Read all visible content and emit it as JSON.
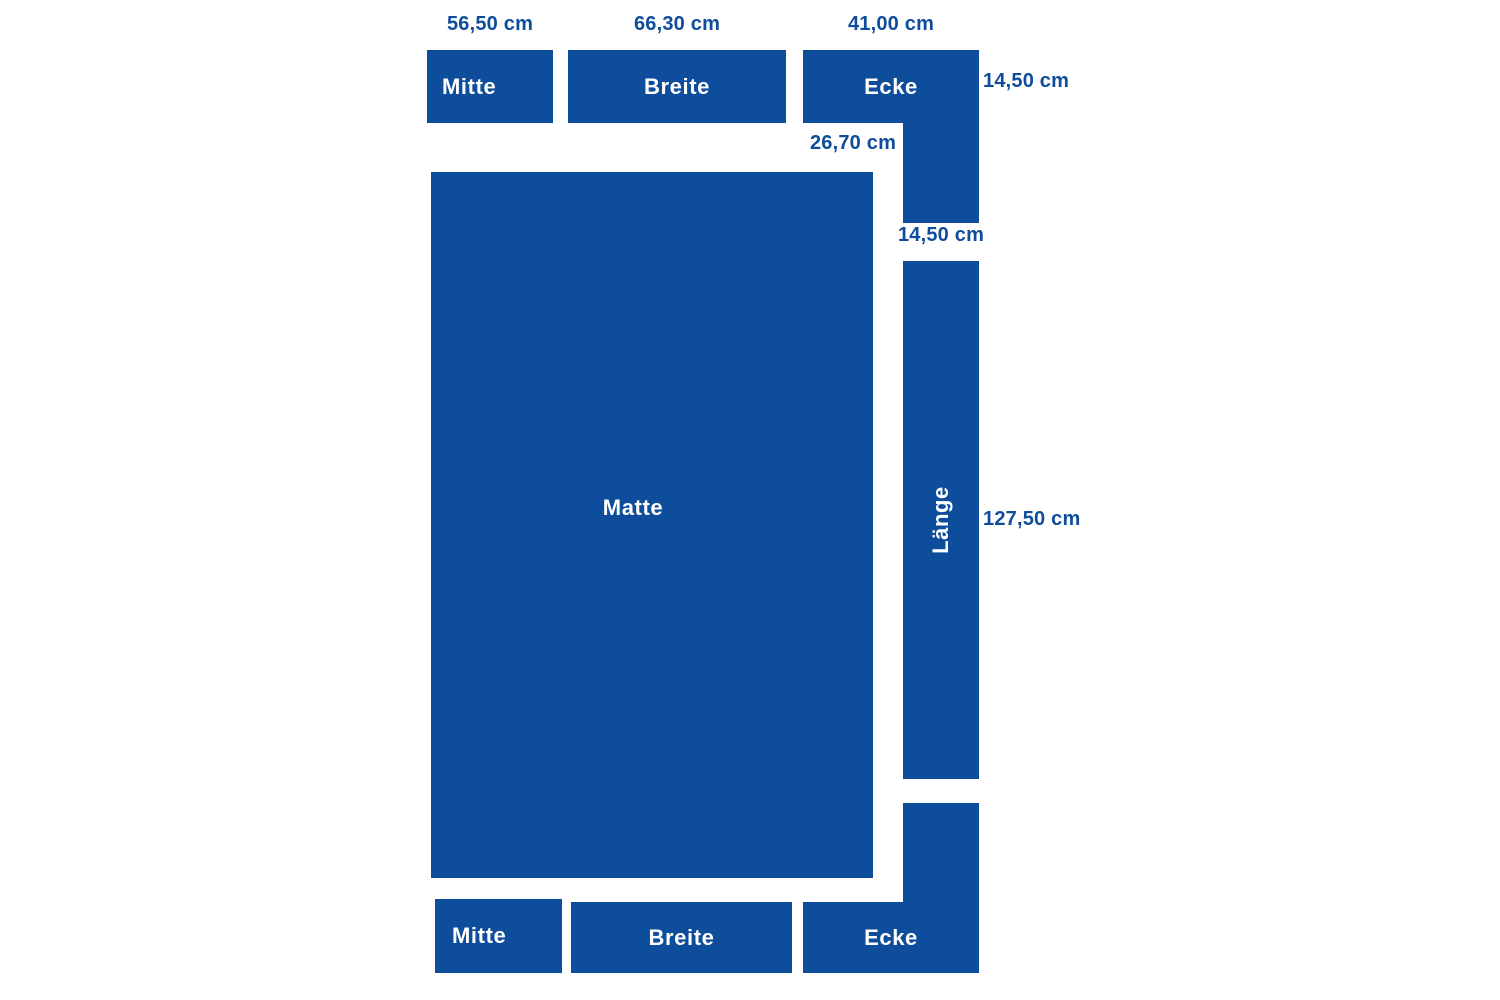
{
  "colors": {
    "primary": "#0e4d9b",
    "background": "#ffffff",
    "piece_label": "#ffffff"
  },
  "pieces": {
    "top_mitte": {
      "label": "Mitte",
      "width_dim": "56,50 cm"
    },
    "top_breite": {
      "label": "Breite",
      "width_dim": "66,30 cm"
    },
    "top_ecke": {
      "label": "Ecke",
      "width_dim": "41,00 cm",
      "side_dim": "14,50 cm",
      "notch_dim": "26,70 cm",
      "leg_dim": "14,50 cm"
    },
    "matte": {
      "label": "Matte"
    },
    "laenge": {
      "label": "Länge",
      "length_dim": "127,50 cm"
    },
    "bottom_mitte": {
      "label": "Mitte"
    },
    "bottom_breite": {
      "label": "Breite"
    },
    "bottom_ecke": {
      "label": "Ecke"
    }
  }
}
